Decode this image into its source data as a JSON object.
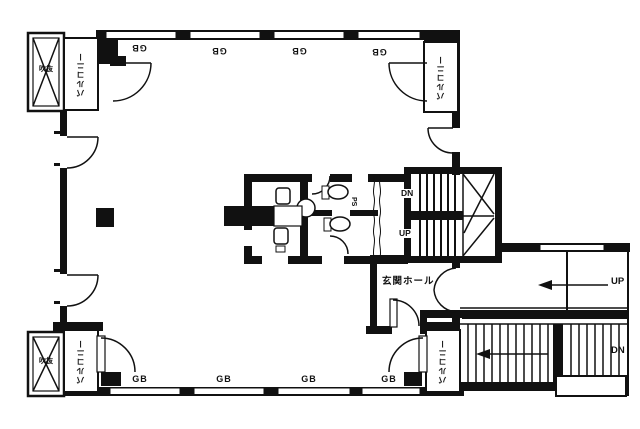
{
  "document": {
    "type": "architectural-floor-plan"
  },
  "colors": {
    "ink": "#111111",
    "paper": "#ffffff"
  },
  "labels": {
    "balcony_top_left": "バルコニー",
    "balcony_top_right": "バルコニー",
    "balcony_bottom_left": "バルコニー",
    "balcony_bottom_right": "バルコニー",
    "void_top_left": "吹抜",
    "void_bottom_left": "吹抜",
    "entrance_hall": "玄関ホール",
    "pipe_space": "PS",
    "internal_stair_down": "DN",
    "internal_stair_up": "UP",
    "external_stair_up": "UP",
    "external_stair_down": "DN"
  },
  "window_marks_top": [
    "GB",
    "GB",
    "GB",
    "GB"
  ],
  "window_marks_bottom": [
    "GB",
    "GB",
    "GB",
    "GB"
  ]
}
